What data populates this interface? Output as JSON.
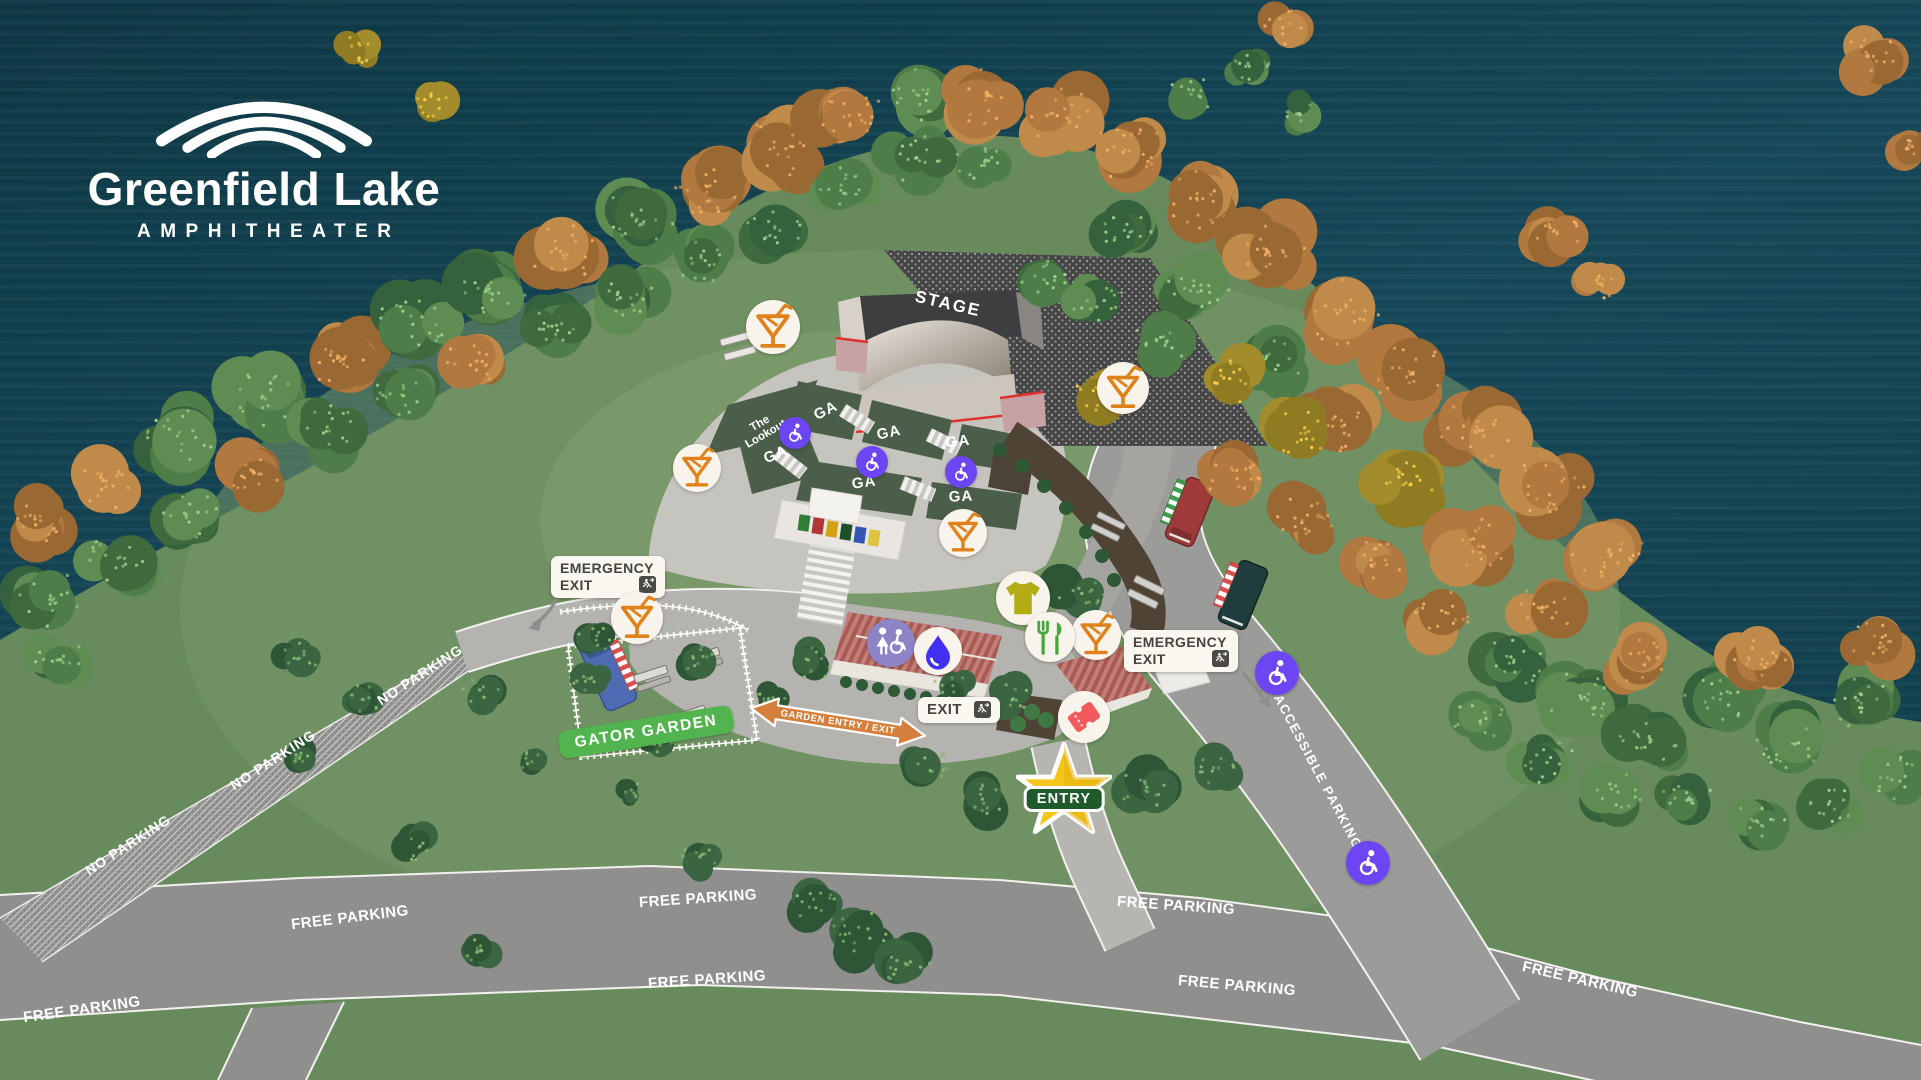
{
  "logo": {
    "title": "Greenfield Lake",
    "subtitle": "AMPHITHEATER"
  },
  "stage": {
    "label": "STAGE"
  },
  "sections": {
    "lookout": "The\nLookout",
    "ga_labels": [
      "GA",
      "GA",
      "GA",
      "GA",
      "GA",
      "GA"
    ]
  },
  "signs": {
    "emergency_exit_left": {
      "line1": "EMERGENCY",
      "line2": "EXIT"
    },
    "emergency_exit_right": {
      "line1": "EMERGENCY",
      "line2": "EXIT"
    },
    "exit": "EXIT",
    "entry": "ENTRY",
    "gator_garden": "GATOR GARDEN",
    "garden_entry_exit": "GARDEN ENTRY / EXIT",
    "accessible_parking": "ACCESSIBLE PARKING"
  },
  "roads": {
    "no_parking_labels": [
      "NO PARKING",
      "NO PARKING",
      "NO PARKING"
    ],
    "free_parking_labels": [
      "FREE PARKING",
      "FREE PARKING",
      "FREE PARKING",
      "FREE PARKING",
      "FREE PARKING",
      "FREE PARKING",
      "FREE PARKING"
    ]
  },
  "markers": {
    "icons": [
      "cocktail-icon",
      "accessible-seating-icon",
      "accessible-parking-icon",
      "restroom-icon",
      "water-refill-icon",
      "merch-tshirt-icon",
      "food-icon",
      "box-office-ticket-icon",
      "exit-run-icon",
      "entry-star-icon"
    ]
  },
  "colors": {
    "water": "#113c49",
    "grass": "#688b5d",
    "road": "#8f8f8d",
    "path": "#b5b3af",
    "section_green": "#4b5e4a",
    "accent_purple": "#6b46f2",
    "accent_orange": "#e0821c",
    "sign_bg": "#faf7f1",
    "sign_text": "#45443f",
    "star_gold": "#f6c51b",
    "entry_green": "#1e5a2a",
    "gator_green": "#52b44e",
    "arrow_orange": "#d4803c",
    "drop_blue": "#4230f0",
    "roof_red": "#b0605c"
  }
}
